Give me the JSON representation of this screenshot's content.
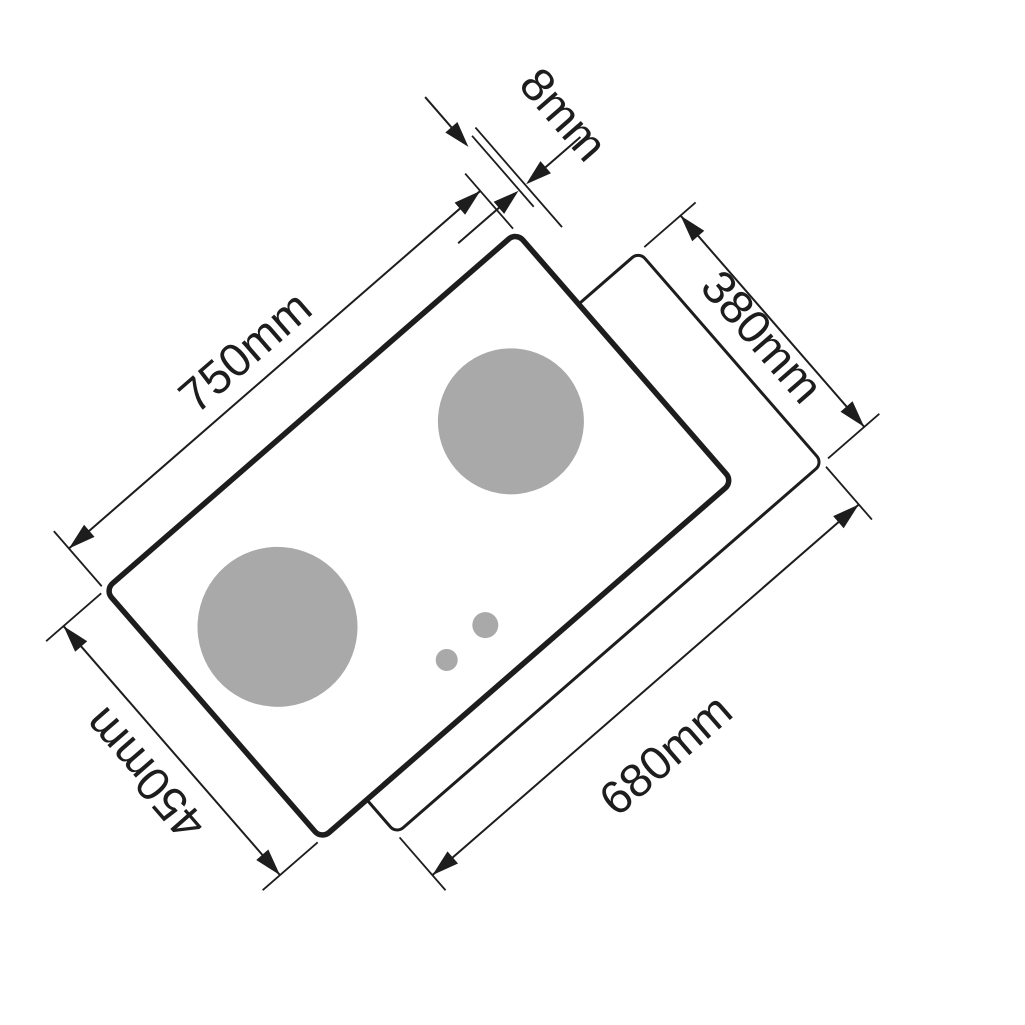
{
  "diagram": {
    "labels": {
      "glass_width": "750mm",
      "glass_thickness": "8mm",
      "cutout_depth": "380mm",
      "glass_depth": "450mm",
      "cutout_width": "680mm"
    },
    "colors": {
      "line": "#1d1d1d",
      "burner": "#a9a9a9",
      "background": "#ffffff"
    }
  }
}
